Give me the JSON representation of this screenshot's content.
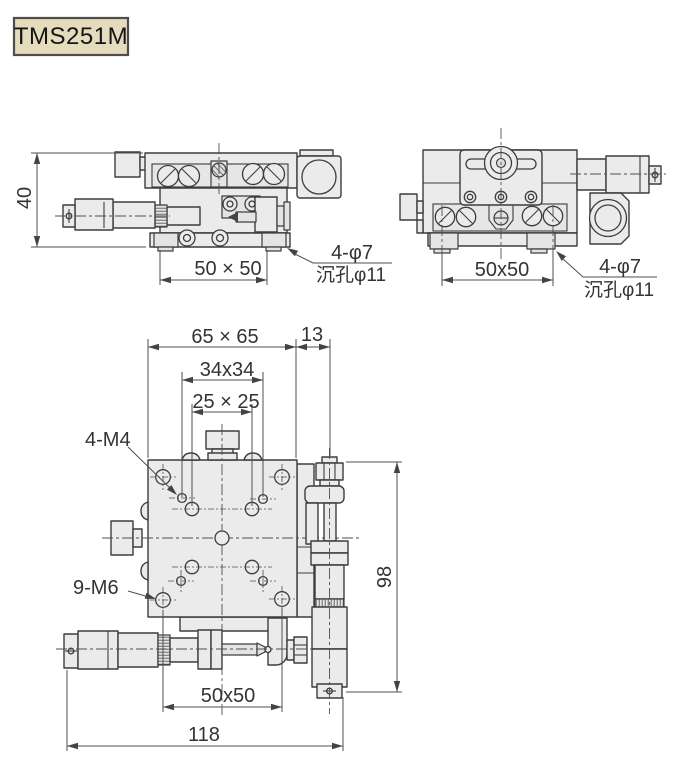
{
  "model_label": "TMS251M",
  "colors": {
    "background": "#ffffff",
    "line": "#3d3d3d",
    "dim_line": "#4f4f4f",
    "part_fill": "#ebebeb",
    "label_box_fill": "#e5dbbd",
    "label_box_border": "#4d4d4d",
    "text": "#333333"
  },
  "views": {
    "side_left": {
      "dim_height": "40",
      "dim_base": "50 × 50",
      "callout_line1": "4-φ7",
      "callout_line2": "沉孔φ11"
    },
    "side_right": {
      "dim_base": "50x50",
      "callout_line1": "4-φ7",
      "callout_line2": "沉孔φ11"
    },
    "top": {
      "dim_plate": "65 × 65",
      "dim_offset": "13",
      "dim_m4_pattern": "34x34",
      "dim_inner_pattern": "25 × 25",
      "callout_m4": "4-M4",
      "callout_m6": "9-M6",
      "dim_mount": "50x50",
      "dim_width": "118",
      "dim_height": "98"
    }
  }
}
